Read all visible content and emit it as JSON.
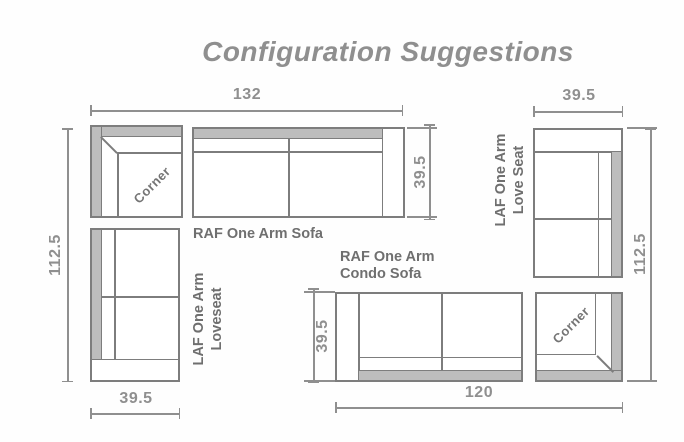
{
  "title": "Configuration Suggestions",
  "colors": {
    "line": "#7d7d7d",
    "fill_gray": "#bdbdbd",
    "text_gray": "#6f6f6f",
    "dim_gray": "#8f8f8f"
  },
  "left_config": {
    "corner_label": "Corner",
    "sofa_label": "RAF One Arm Sofa",
    "loveseat_label": [
      "LAF One Arm",
      "Loveseat"
    ],
    "dims": {
      "top_width": "132",
      "left_height": "112.5",
      "sofa_depth": "39.5",
      "loveseat_width": "39.5"
    }
  },
  "right_config": {
    "corner_label": "Corner",
    "loveseat_label": [
      "LAF One Arm",
      "Love Seat"
    ],
    "condo_label": [
      "RAF One Arm",
      "Condo Sofa"
    ],
    "dims": {
      "top_width": "39.5",
      "right_height": "112.5",
      "condo_depth": "39.5",
      "bottom_width": "120"
    }
  }
}
